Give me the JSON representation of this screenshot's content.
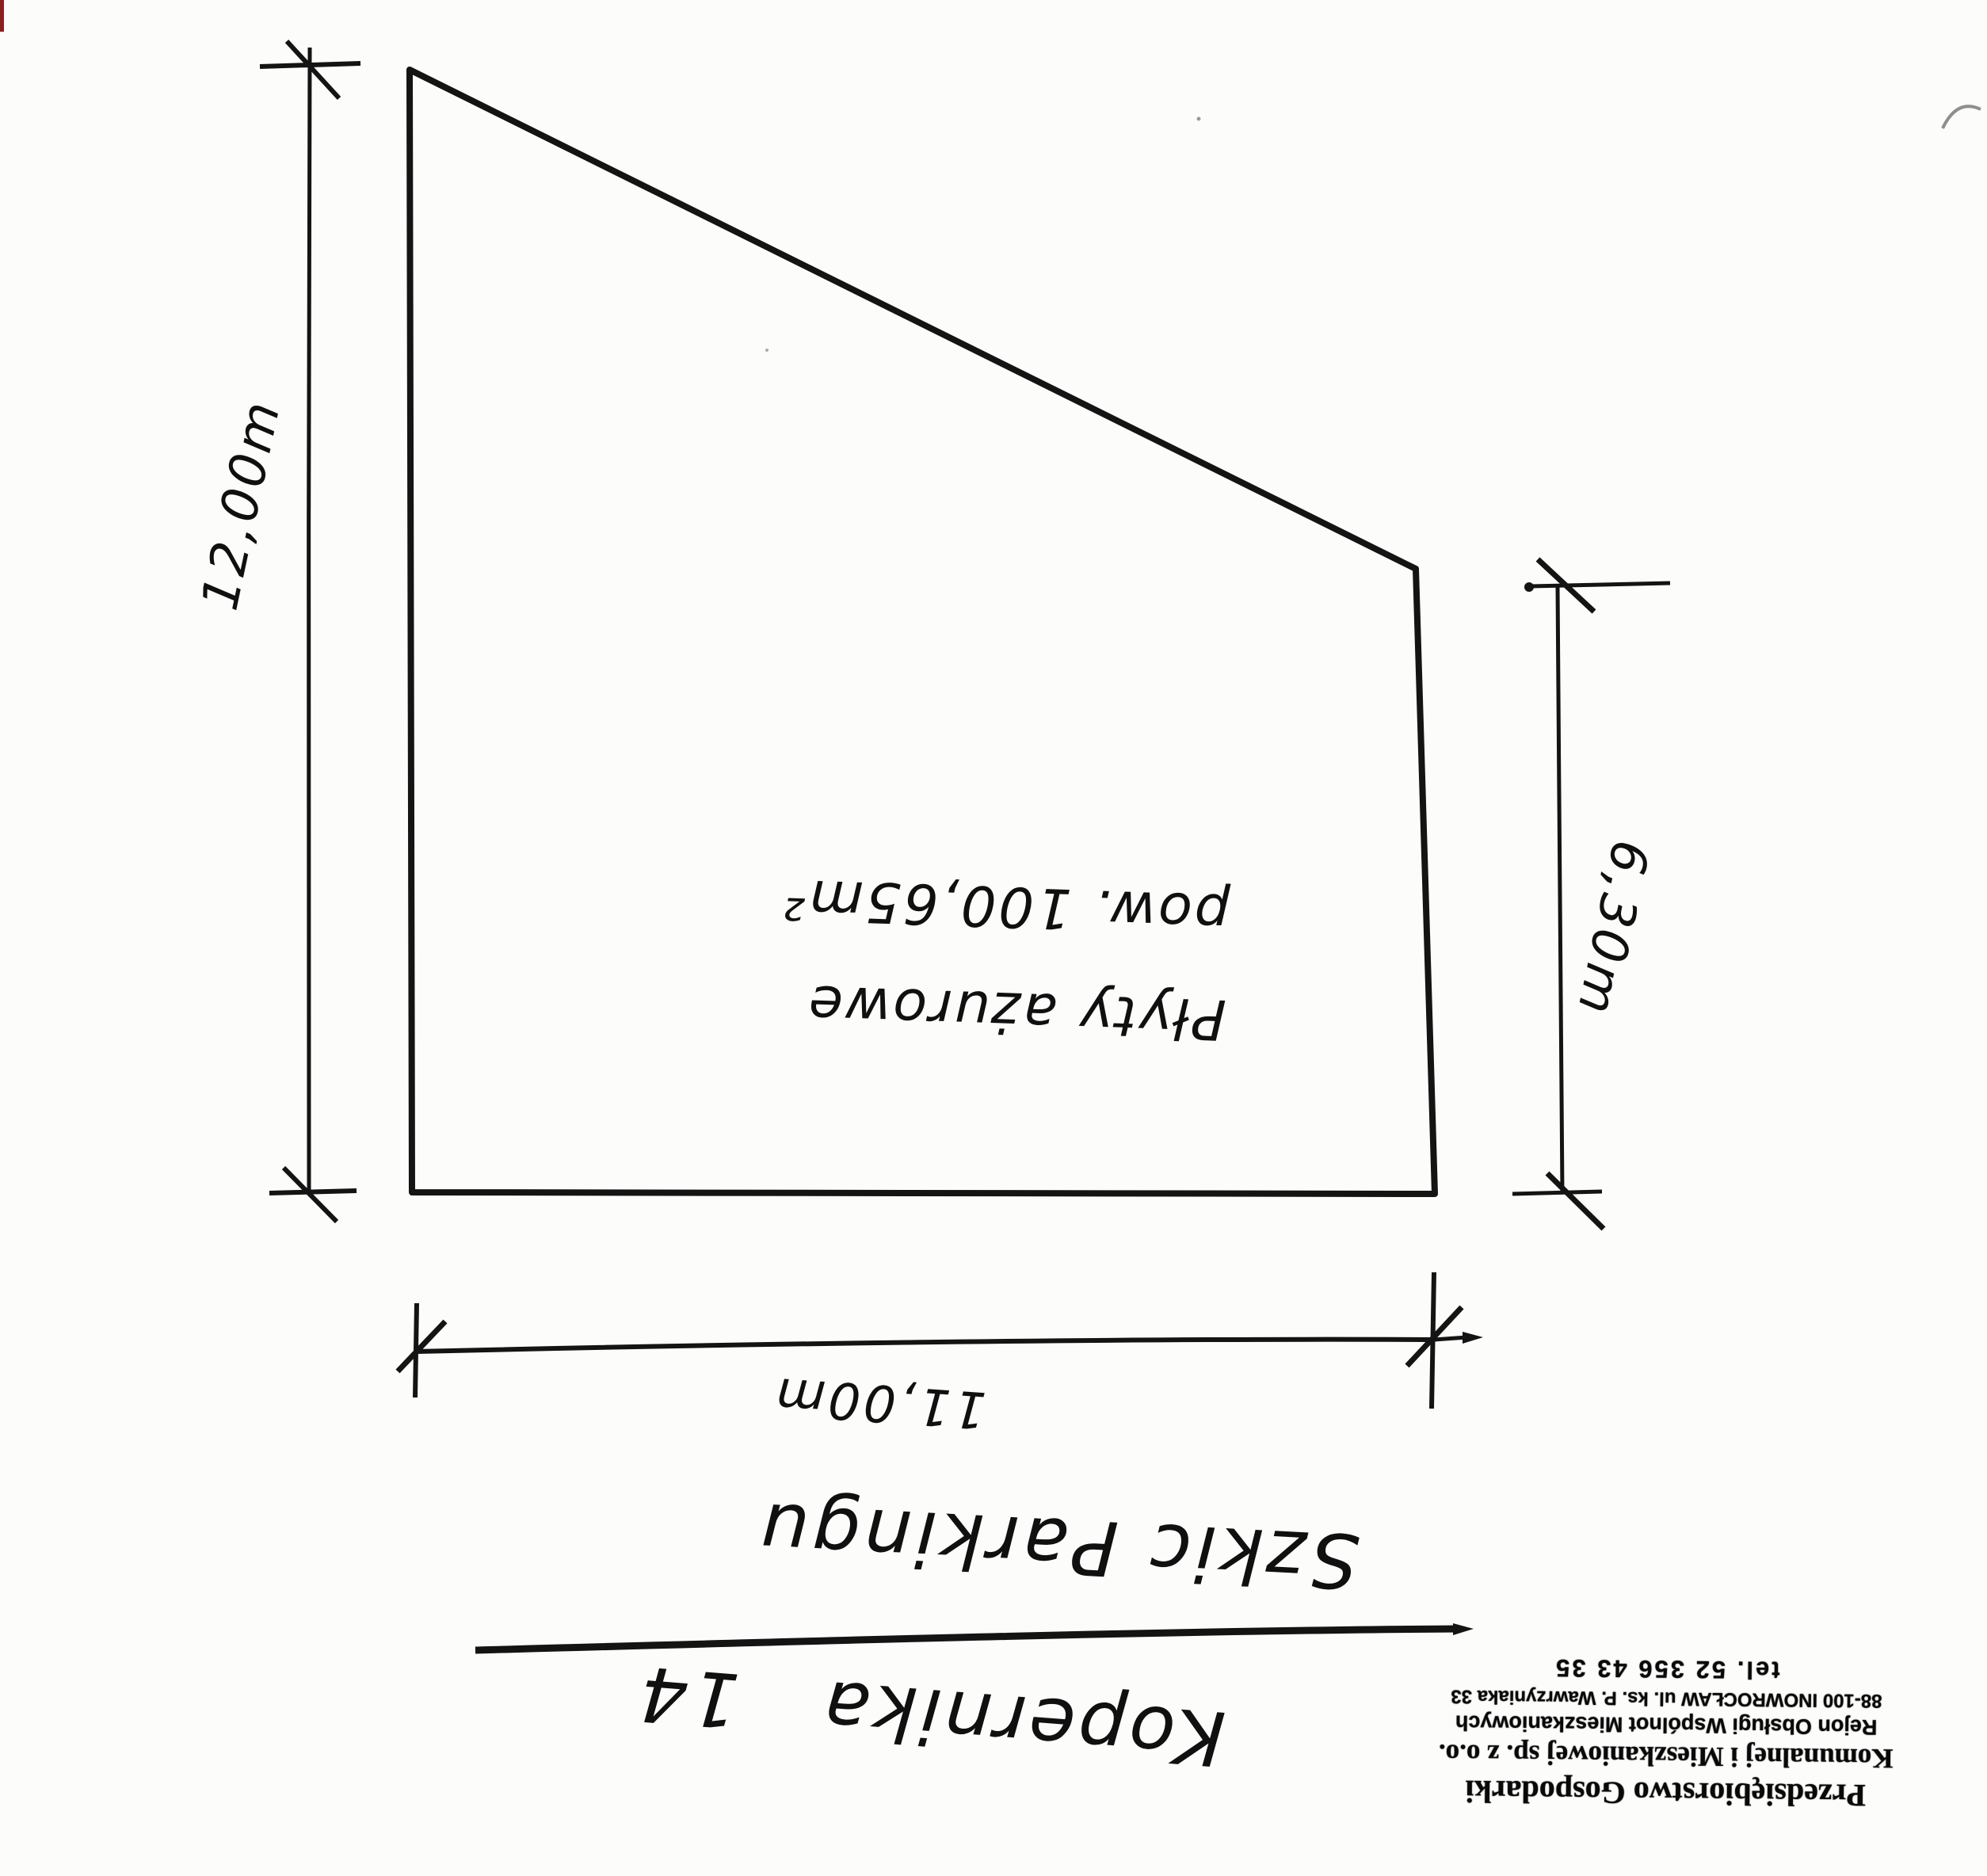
{
  "sheet": {
    "background": "#fcfcfb",
    "ink": "#141414"
  },
  "sketch": {
    "area_note": {
      "line1": "Płyty ażurowe",
      "line2": "pow. 100,65m²"
    },
    "dimensions": {
      "left": "12,00m",
      "right": "6,30m",
      "bottom": "11,00m"
    }
  },
  "caption": {
    "title": "Szkic Parkingu",
    "address": "Kopernika 14"
  },
  "stamp": {
    "line1": "Przedsiębiorstwo Gospodarki",
    "line2": "Komunalnej i Mieszkaniowej sp. z o.o.",
    "line3": "Rejon Obsługi Wspólnot Mieszkaniowych",
    "line4": "88-100 INOWROCŁAW ul. ks. P. Wawrzyniaka 33",
    "line5": "tel. 52 356 43 35"
  }
}
